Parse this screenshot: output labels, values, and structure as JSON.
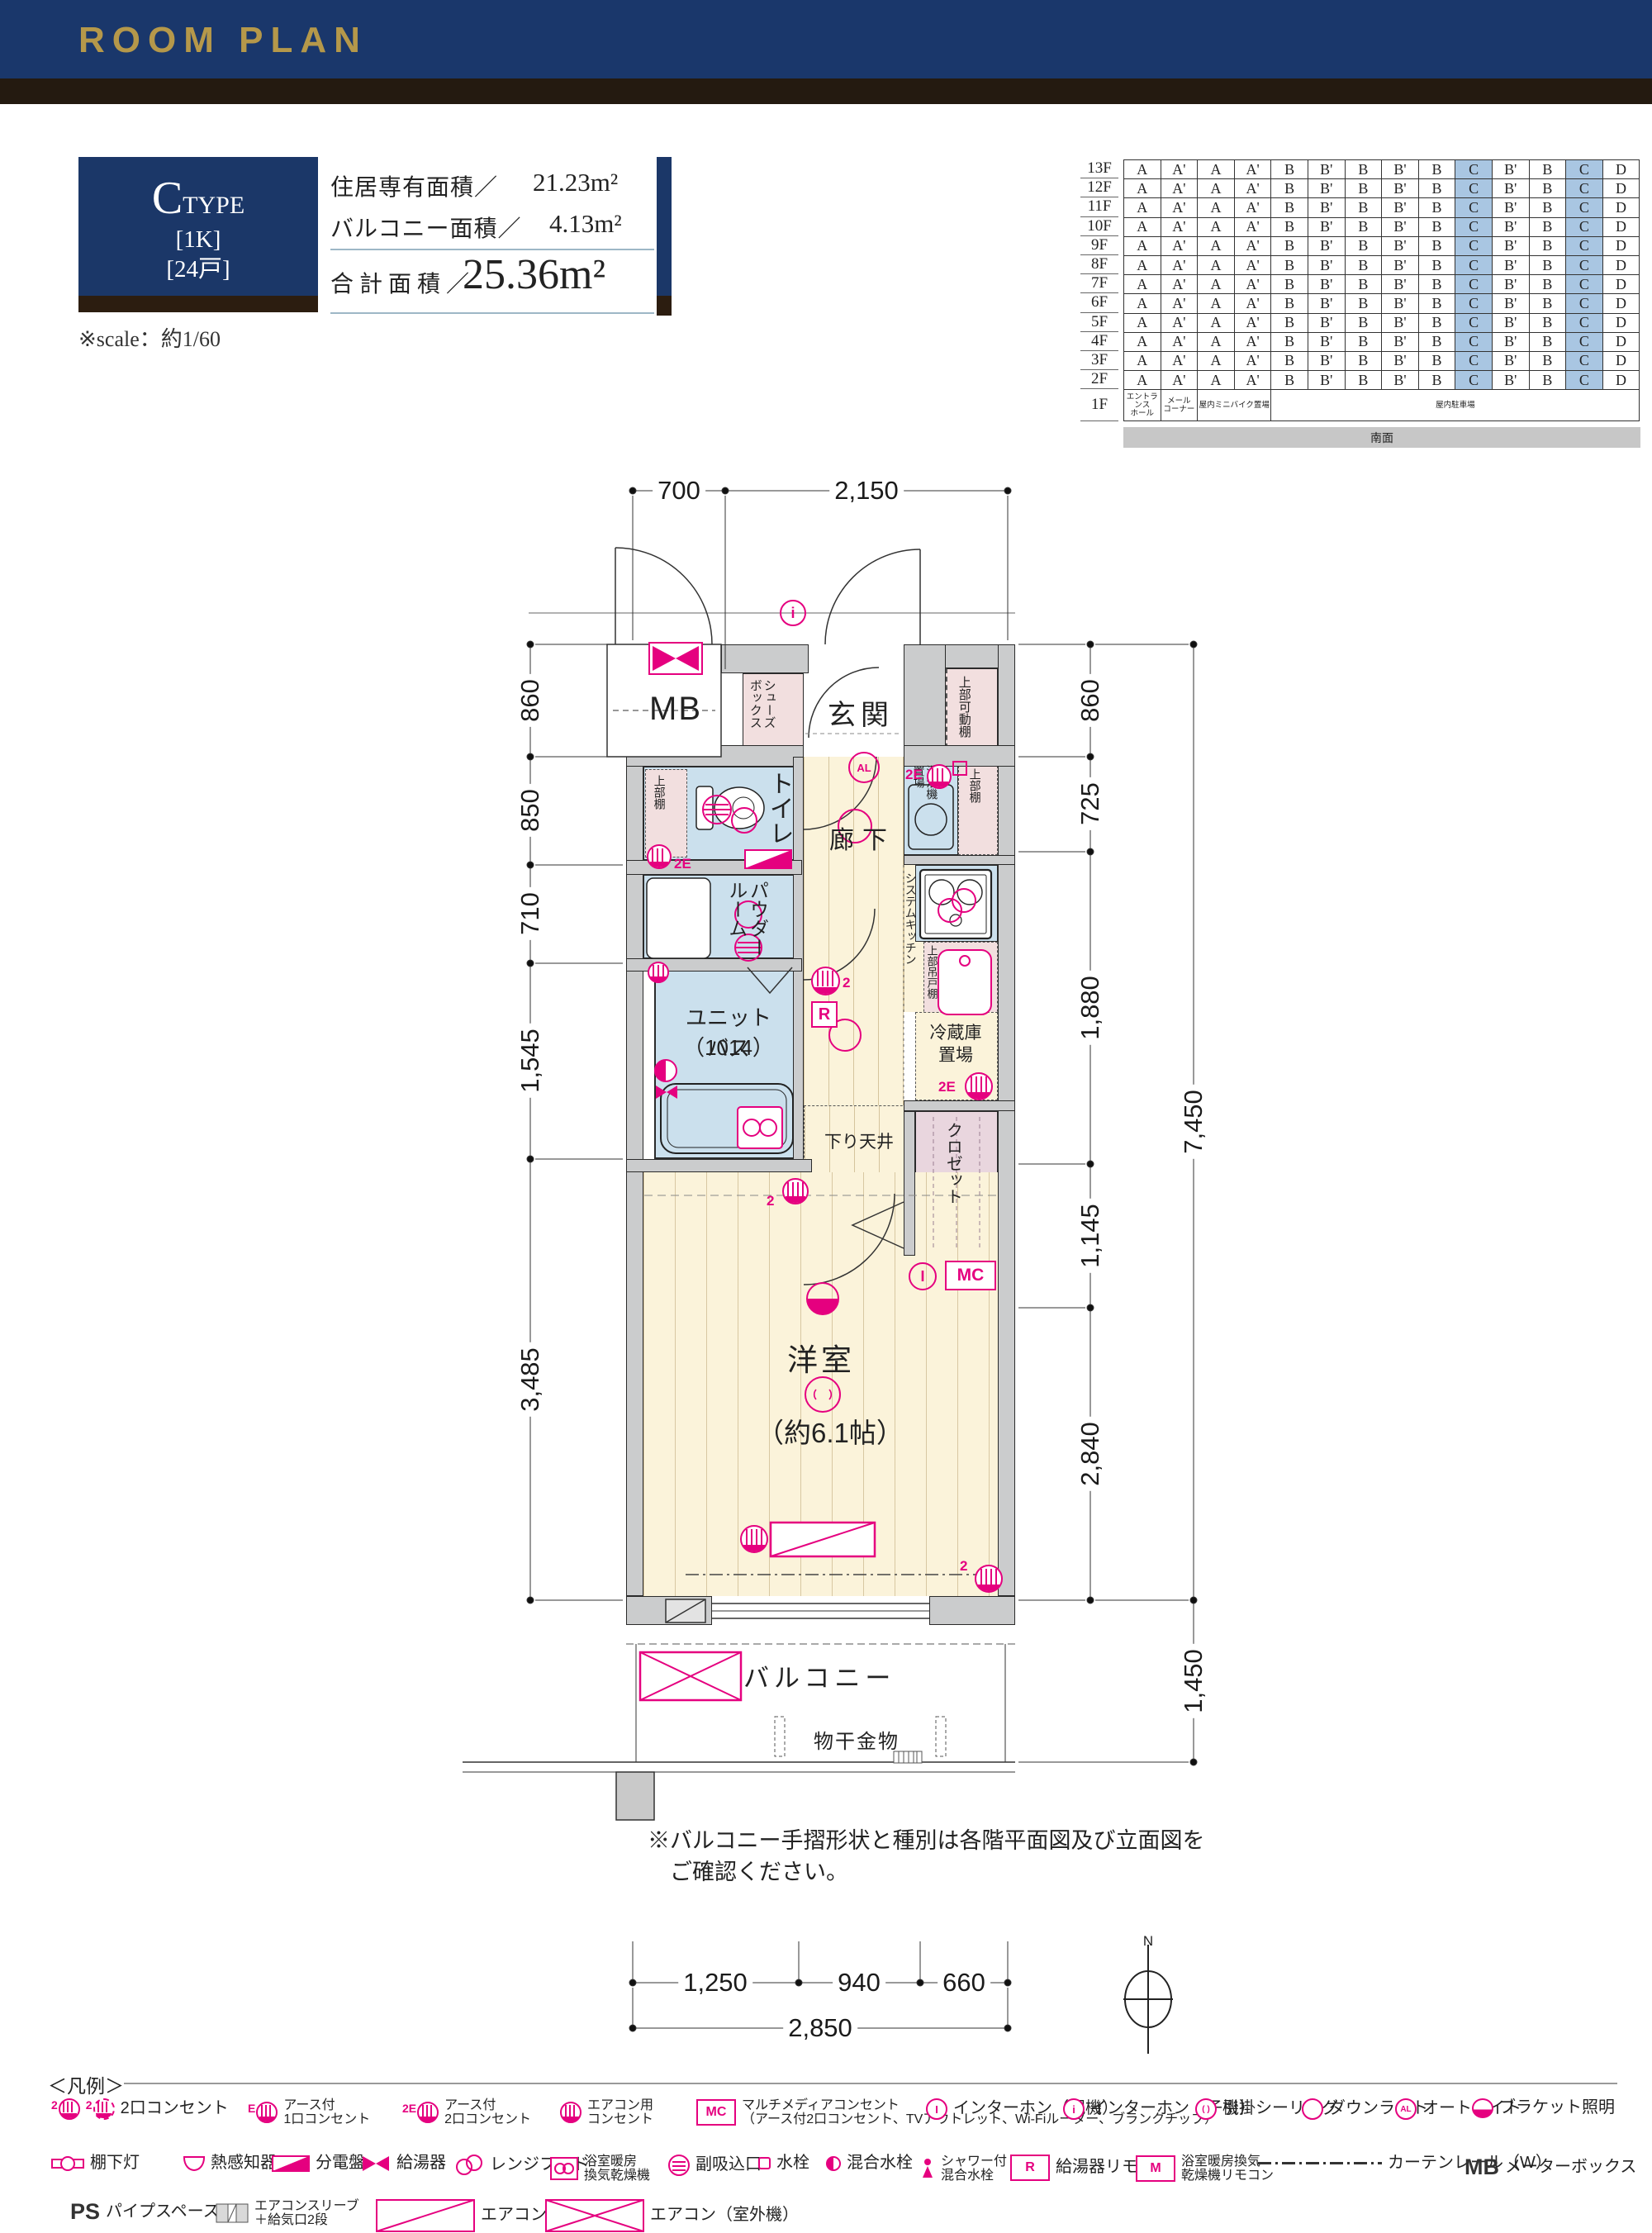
{
  "header": {
    "title": "ROOM PLAN"
  },
  "type_box": {
    "letter": "C",
    "word": "TYPE",
    "plan": "[1K]",
    "units": "[24戸]"
  },
  "scale_note": "※scale：約1/60",
  "areas": {
    "rows": [
      {
        "label": "住居専有面積／",
        "value": "21.23m²"
      },
      {
        "label": "バルコニー面積／",
        "value": "4.13m²"
      }
    ],
    "total_label": "合 計 面 積 ／",
    "total_value": "25.36m²"
  },
  "floor_table": {
    "floors": [
      "13F",
      "12F",
      "11F",
      "10F",
      "9F",
      "8F",
      "7F",
      "6F",
      "5F",
      "4F",
      "3F",
      "2F"
    ],
    "first_floor_label": "1F",
    "unit_columns": [
      "A",
      "A'",
      "A",
      "A'",
      "B",
      "B'",
      "B",
      "B'",
      "B",
      "C",
      "B'",
      "B",
      "C",
      "D"
    ],
    "highlight_columns": [
      9,
      12
    ],
    "first_floor": [
      "エントランス\nホール",
      "メール\nコーナー",
      "屋内ミニバイク置場",
      "屋内駐車場"
    ],
    "south_label": "南面"
  },
  "dims": {
    "top": [
      "700",
      "2,150"
    ],
    "left": [
      "860",
      "850",
      "710",
      "1,545",
      "3,485"
    ],
    "right": [
      "860",
      "725",
      "1,880",
      "1,145",
      "2,840"
    ],
    "right_total": "7,450",
    "balcony": "1,450",
    "bottom": [
      "1,250",
      "940",
      "660"
    ],
    "bottom_total": "2,850"
  },
  "rooms": {
    "mb": "MB",
    "shoes": "シューズ\nボックス",
    "genkan": "玄関",
    "movable_shelf": "上部可動棚",
    "toilet": "トイレ",
    "toilet_shelf": "上部棚",
    "hallway": "廊下",
    "washer": "洗濯機\n置場",
    "washer_shelf": "上部棚",
    "powder": "パウダー\nルーム",
    "kitchen": "システムキッチン",
    "hanging_cupboard": "上部吊戸棚",
    "unit_bath": "ユニットバス",
    "unit_bath_size": "（1014）",
    "fridge": "冷蔵庫\n置場",
    "down_ceiling": "下り天井",
    "closet": "クロゼット",
    "western": "洋室",
    "western_size": "（約6.1帖）",
    "balcony": "バルコニー",
    "laundry": "物干金物"
  },
  "plan_symbols": {
    "mc": "MC",
    "r": "R",
    "al": "AL",
    "intercom_child": "i",
    "intercom_parent": "I",
    "e2": "2E",
    "two": "2",
    "north": "N"
  },
  "notes": {
    "line1": "※バルコニー手摺形状と種別は各階平面図及び立面図を",
    "line2": "　ご確認ください。"
  },
  "legend": {
    "title": "＜凡例＞",
    "rows": [
      [
        {
          "id": "out2",
          "label": "2口コンセント"
        },
        {
          "id": "out1e",
          "label": "アース付\n1口コンセント"
        },
        {
          "id": "out2e",
          "label": "アース付\n2口コンセント"
        },
        {
          "id": "outac",
          "label": "エアコン用\nコンセント"
        },
        {
          "id": "mc",
          "label": "マルチメディアコンセント\n（アース付2口コンセント、TVアウトレット、Wi-Fiルーター、ブランクチップ）"
        },
        {
          "id": "iph_p",
          "label": "インターホン（親機）"
        },
        {
          "id": "iph_c",
          "label": "インターホン（子機）"
        },
        {
          "id": "hook",
          "label": "引掛シーリング"
        },
        {
          "id": "down",
          "label": "ダウンライト"
        },
        {
          "id": "al",
          "label": "オートライト"
        },
        {
          "id": "bracket",
          "label": "ブラケット照明"
        }
      ],
      [
        {
          "id": "shelf_light",
          "label": "棚下灯"
        },
        {
          "id": "heat",
          "label": "熱感知器"
        },
        {
          "id": "bunden",
          "label": "分電盤"
        },
        {
          "id": "kyuto",
          "label": "給湯器"
        },
        {
          "id": "range",
          "label": "レンジフード"
        },
        {
          "id": "bathdry",
          "label": "浴室暖房\n換気乾燥機"
        },
        {
          "id": "intake",
          "label": "副吸込口"
        },
        {
          "id": "faucet",
          "label": "水栓"
        },
        {
          "id": "mix",
          "label": "混合水栓"
        },
        {
          "id": "shower",
          "label": "シャワー付\n混合水栓"
        },
        {
          "id": "r_remote",
          "label": "給湯器リモコン"
        },
        {
          "id": "m_remote",
          "label": "浴室暖房換気\n乾燥機リモコン"
        },
        {
          "id": "curtain",
          "label": "カーテンレール（W）"
        },
        {
          "id": "mbx",
          "label": "メーターボックス"
        }
      ],
      [
        {
          "id": "ps",
          "label": "パイプスペース"
        },
        {
          "id": "sleeve",
          "label": "エアコンスリーブ\n＋給気口2段"
        },
        {
          "id": "ac_in",
          "label": "エアコン（室内機）"
        },
        {
          "id": "ac_out",
          "label": "エアコン（室外機）"
        }
      ]
    ],
    "icon_texts": {
      "mc": "MC",
      "r": "R",
      "m": "M",
      "mb": "MB",
      "ps": "PS",
      "al": "AL",
      "i_parent": "I",
      "i_child": "i"
    }
  }
}
